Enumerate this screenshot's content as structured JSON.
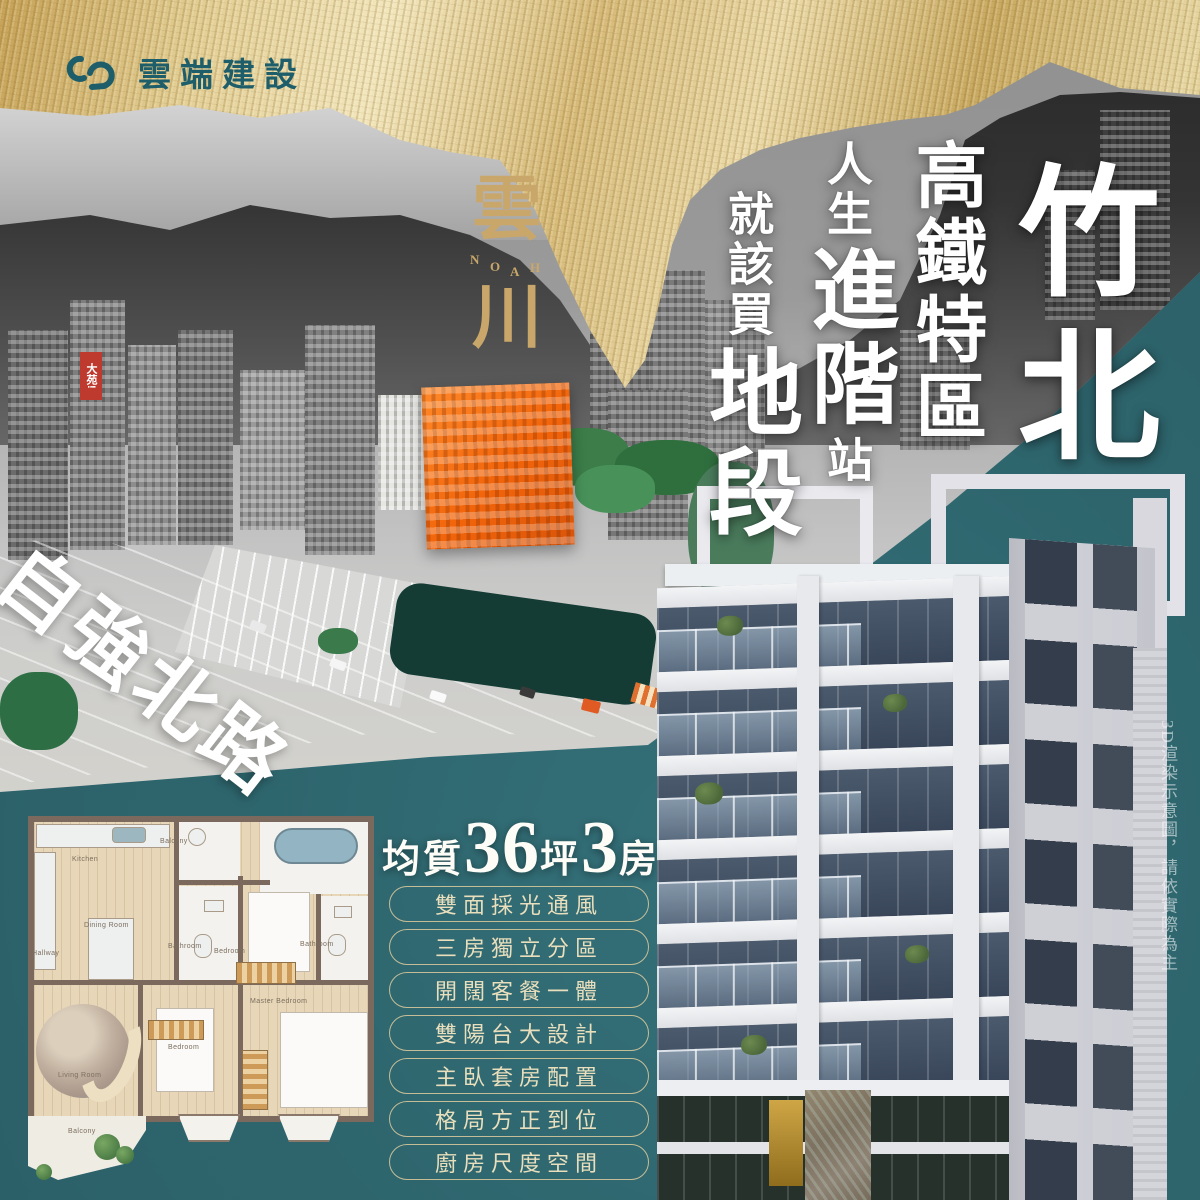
{
  "brand": {
    "developer": "雲端建設",
    "project_top": "雲",
    "project_bottom": "川",
    "noah": [
      "N",
      "O",
      "A",
      "H"
    ]
  },
  "headline": {
    "city": "竹北",
    "district": "高鐵特區",
    "p1_top": "人生",
    "p1_main": "進階",
    "p1_bottom": "站",
    "p2_small": "就該買",
    "p2_main": "地段"
  },
  "photo": {
    "road_label": "自強北路",
    "sign": "大苑!"
  },
  "spec": {
    "prefix": "均質",
    "area": "36",
    "area_unit": "坪",
    "rooms": "3",
    "rooms_unit": "房"
  },
  "features": [
    "雙面採光通風",
    "三房獨立分區",
    "開闊客餐一體",
    "雙陽台大設計",
    "主臥套房配置",
    "格局方正到位",
    "廚房尺度空間"
  ],
  "render_note": "3D渲染示意圖，請依實際為主",
  "floorplan": {
    "labels": [
      "Kitchen",
      "Balcony",
      "Dining Room",
      "Hallway",
      "Bathroom",
      "Bedroom",
      "Bathroom",
      "Master Bedroom",
      "Bedroom",
      "Living Room",
      "Balcony"
    ]
  },
  "colors": {
    "teal_background": "#2e656d",
    "gold_band": "#dcc486",
    "brand_gold": "#c9a76b",
    "logo_teal": "#1e5e6a",
    "highlight_building_orange": "#f2640a",
    "headline_white": "#ffffff"
  }
}
